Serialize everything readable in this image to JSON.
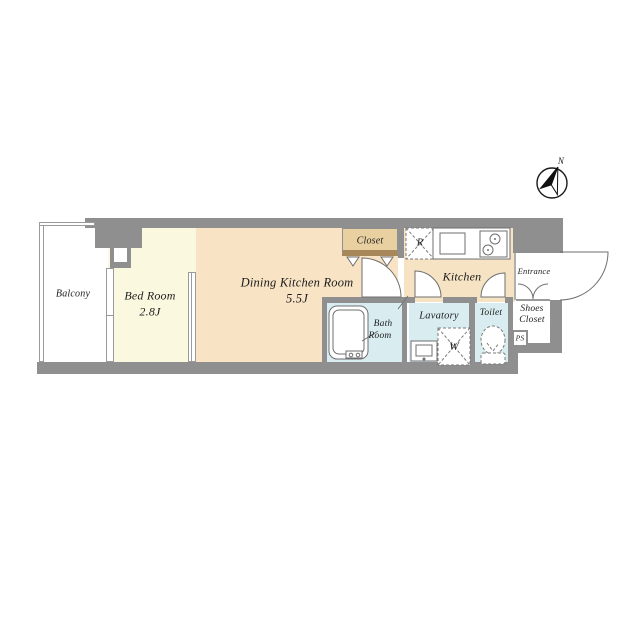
{
  "plan": {
    "compass": {
      "north_label": "N"
    },
    "rooms": {
      "balcony": {
        "label": "Balcony"
      },
      "bed_room": {
        "label": "Bed Room",
        "size": "2.8J"
      },
      "dining_kitchen_room": {
        "label": "Dining Kitchen Room",
        "size": "5.5J"
      },
      "kitchen": {
        "label": "Kitchen"
      },
      "closet": {
        "label": "Closet"
      },
      "entrance": {
        "label": "Entrance"
      },
      "shoes_closet": {
        "line1": "Shoes",
        "line2": "Closet"
      },
      "pipe_space": {
        "label": "PS"
      },
      "toilet": {
        "label": "Toilet"
      },
      "lavatory": {
        "label": "Lavatory"
      },
      "bath_room": {
        "line1": "Bath",
        "line2": "Room"
      }
    },
    "fixtures": {
      "refrigerator_space": {
        "label": "R"
      },
      "washing_machine_space": {
        "label": "W"
      }
    },
    "colors": {
      "wall": "#8f8f8f",
      "dk_floor": "#f8e3c5",
      "bedroom_floor": "#fbf8e0",
      "kitchen_floor": "#f5e3c3",
      "closet_floor": "#e8d0a0",
      "closet_edge": "#a8875a",
      "wet_floor": "#d9edf1",
      "line": "#6f6f6f",
      "text": "#1c1c1c"
    }
  }
}
